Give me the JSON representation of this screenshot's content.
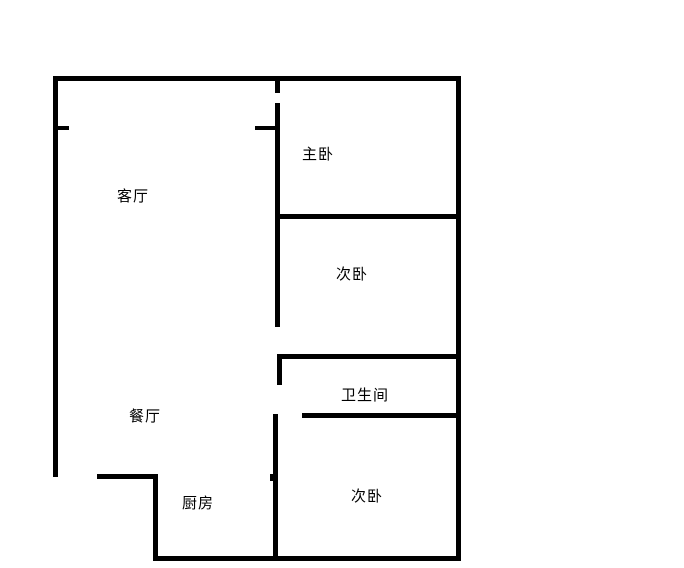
{
  "page": {
    "background_color": "#ffffff",
    "wall_color": "#000000",
    "text_color": "#000000"
  },
  "floor_plan": {
    "rooms": [
      {
        "id": "living-room",
        "label": "客厅"
      },
      {
        "id": "master-bedroom",
        "label": "主卧"
      },
      {
        "id": "second-bedroom-upper",
        "label": "次卧"
      },
      {
        "id": "bathroom",
        "label": "卫生间"
      },
      {
        "id": "dining-room",
        "label": "餐厅"
      },
      {
        "id": "kitchen",
        "label": "厨房"
      },
      {
        "id": "second-bedroom-lower",
        "label": "次卧"
      }
    ]
  }
}
